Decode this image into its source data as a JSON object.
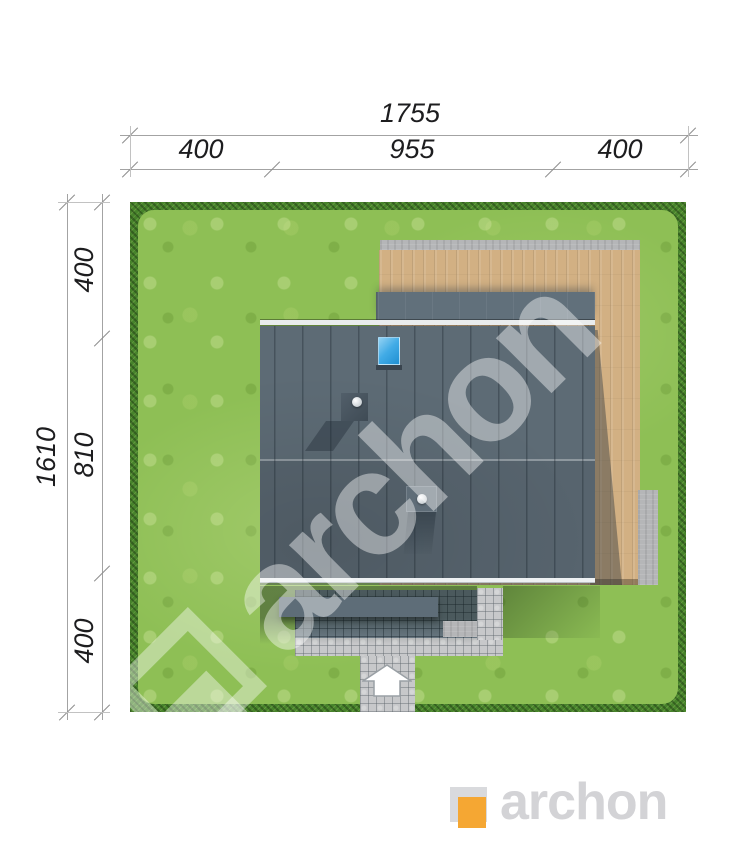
{
  "brand": {
    "name": "archon"
  },
  "dimensions": {
    "top": {
      "total": "1755",
      "segments": [
        "400",
        "955",
        "400"
      ]
    },
    "left": {
      "total": "1610",
      "segments": [
        "400",
        "810",
        "400"
      ]
    }
  },
  "watermark": {
    "text": "archon"
  },
  "footer": {
    "brand_text": "archon",
    "accent_color": "#F5A733",
    "text_color": "#D3D3D6"
  },
  "site_plan": {
    "type": "house-plot-top-view",
    "entrance_arrow_direction": "up",
    "colors": {
      "grass": "#8EBF55",
      "hedge_border": "#47832B",
      "roof_main": "#5D6B75",
      "roof_secondary": "#61707B",
      "deck_wood": "#D2B083",
      "concrete": "#B5B6B8",
      "paving_light": "#C7C8CA",
      "paving_shadow": "#71808C",
      "skylight_blue": "#41ABE6"
    },
    "features": [
      "grass-plot",
      "hedge-border",
      "concrete-strip",
      "wooden-deck",
      "secondary-roof-slope",
      "ridge",
      "main-roof",
      "eave",
      "skylight",
      "chimney",
      "roof-vent",
      "porch-canopy",
      "paved-entrance",
      "concrete-pad",
      "walkway",
      "entrance-arrow",
      "side-concrete-pad"
    ]
  }
}
